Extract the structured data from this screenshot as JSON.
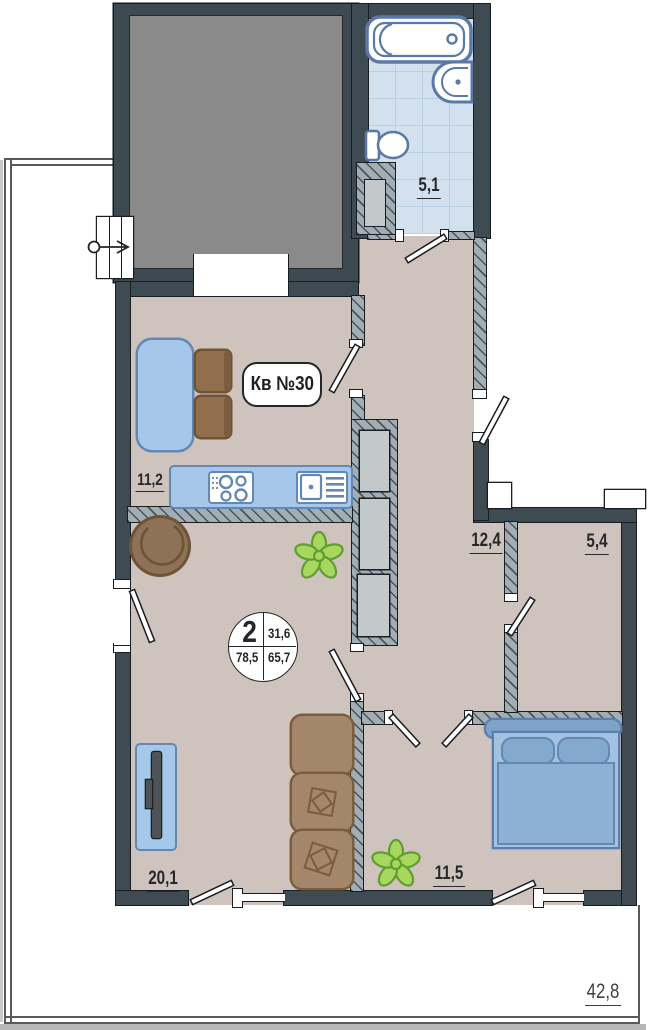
{
  "plan": {
    "badge": "Кв №30",
    "stamp": {
      "room_count": "2",
      "top_right": "31,6",
      "bottom_left": "78,5",
      "bottom_right": "65,7"
    },
    "areas": {
      "bathroom": "5,1",
      "kitchen": "11,2",
      "hallway": "12,4",
      "storage": "5,4",
      "living_room": "20,1",
      "bedroom": "11,5",
      "terrace": "42,8"
    },
    "colors": {
      "bearing_wall": "#3f4b53",
      "floor": "#cfc3bd",
      "fixture_blue": "#6488b4",
      "furniture_blue": "#a5c8ea",
      "sofa_brown": "#a4876b",
      "plant_green": "#a8d75f",
      "tile_blue": "#d3e1ee",
      "shaft_gray": "#8a8a8a"
    }
  }
}
